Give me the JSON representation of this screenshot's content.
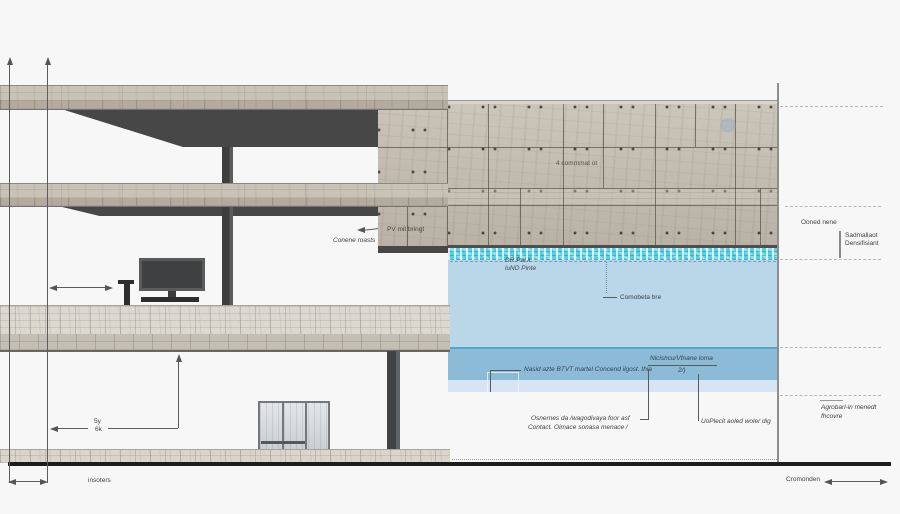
{
  "labels": {
    "conene_roasts": "Conene roasts",
    "pv_note": "PV mit bringt",
    "wall_panel_note": "4 commmat ot",
    "or_pal_line1": "DR Pal li",
    "or_pal_line2": "luND Pinte",
    "comobeta": "Comobeta bre",
    "nasid_note": "Nasid azte BTVT martel Concend ilgost. thia",
    "nicishcu_line1": "Nicishcu/Vfnane loma",
    "nicishcu_line2": "2/)",
    "osnernes_line1": "Osnernes da /wagodivaya foor asf",
    "osnernes_line2": "Contact. Oimace sonasa menace /",
    "uoplecit": "UoPlecit aoled woler dig",
    "ooned_nene": "Ooned nene",
    "sadmal_line1": "Sadmallaot",
    "sadmal_line2": "Densifisiant",
    "agrobarl_line1": "Agrobarl-in menedt",
    "agrobarl_line2": "fhcovre",
    "cromonden": "Cromonden",
    "dim_upper": "5y",
    "dim_lower": "6k",
    "insoters": "insoters"
  },
  "colors": {
    "water_surface": "#55cfe4",
    "water_body": "#b9d7e8",
    "water_deep": "#8cbbd7",
    "water_shallow": "#d7e4f3",
    "concrete": "#c6c0b3",
    "dark_structure": "#474747",
    "background": "#f7f7f8"
  }
}
